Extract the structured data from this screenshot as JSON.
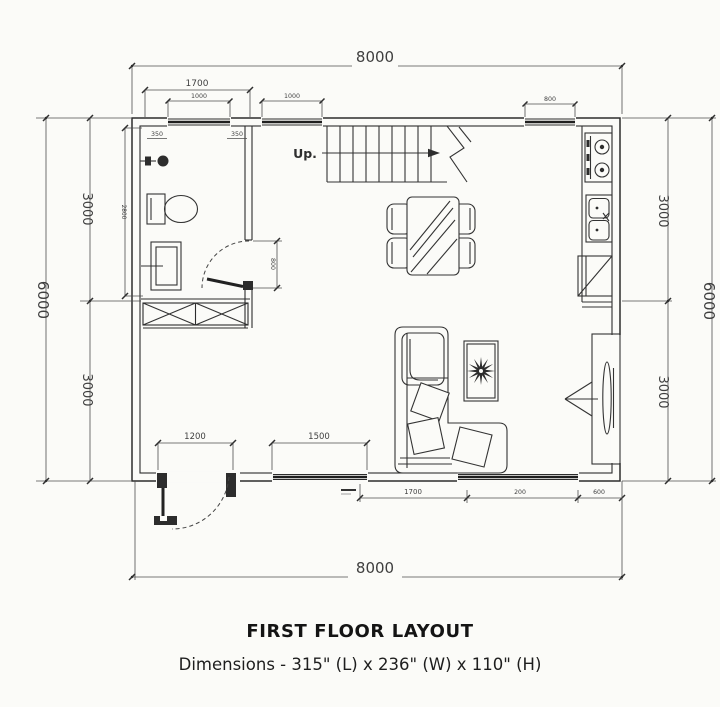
{
  "colors": {
    "background": "#fbfbf8",
    "line": "#2c2c2c",
    "dim_text": "#3f3f3f",
    "title_text": "#141414"
  },
  "plan": {
    "up_label": "Up."
  },
  "dims": {
    "top_overall": "8000",
    "bottom_overall": "8000",
    "left_overall": "6000",
    "right_overall": "6000",
    "left_upper": "3000",
    "left_lower": "3000",
    "right_upper": "3000",
    "right_lower": "3000",
    "bath_width": "1700",
    "bath_window": "1000",
    "stair_window": "1000",
    "kitchen_window": "800",
    "offset_left": "350",
    "offset_right": "350",
    "bath_depth": "2800",
    "bath_door": "800",
    "entry_door": "1200",
    "living_window": "1500",
    "bottom_seg_1": "1700",
    "bottom_seg_2": "200",
    "bottom_seg_3": "600"
  },
  "footer": {
    "title": "FIRST FLOOR LAYOUT",
    "subtitle": "Dimensions - 315\" (L) x 236\" (W) x 110\" (H)"
  }
}
